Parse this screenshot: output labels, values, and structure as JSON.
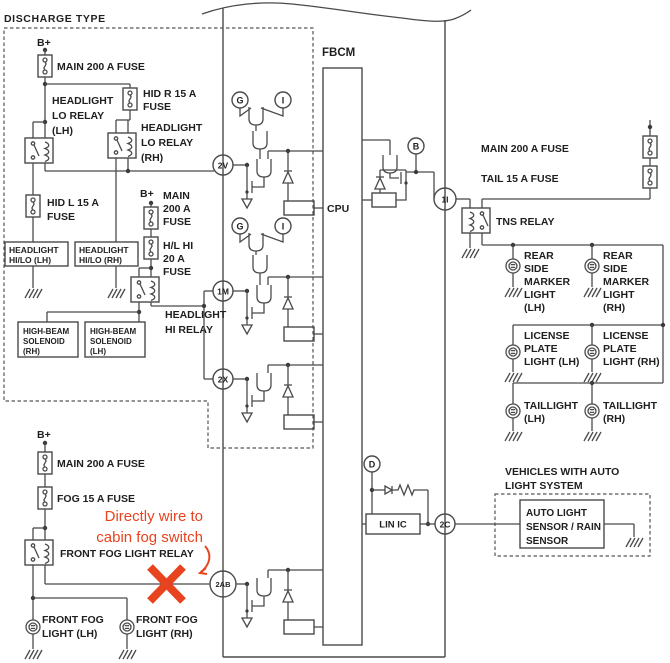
{
  "colors": {
    "line": "#4a4a4a",
    "text": "#1f1f1f",
    "red": "#e8431f",
    "background": "#ffffff"
  },
  "labels": {
    "discharge_type": "DISCHARGE TYPE",
    "b_plus": "B+",
    "fbcm": "FBCM",
    "cpu": "CPU",
    "lin_ic": "LIN IC"
  },
  "left": {
    "main_fuse1": "MAIN 200 A FUSE",
    "lo_relay_lh": [
      "HEADLIGHT",
      "LO RELAY",
      "(LH)"
    ],
    "hid_r": [
      "HID R 15 A",
      "FUSE"
    ],
    "lo_relay_rh": [
      "HEADLIGHT",
      "LO RELAY",
      "(RH)"
    ],
    "hid_l": [
      "HID L 15 A",
      "FUSE"
    ],
    "main_fuse2": [
      "MAIN",
      "200 A",
      "FUSE"
    ],
    "hl_hi": [
      "H/L HI",
      "20 A",
      "FUSE"
    ],
    "hilo_lh": [
      "HEADLIGHT",
      "HI/LO (LH)"
    ],
    "hilo_rh": [
      "HEADLIGHT",
      "HI/LO (RH)"
    ],
    "sol_rh": [
      "HIGH-BEAM",
      "SOLENOID",
      "(RH)"
    ],
    "sol_lh": [
      "HIGH-BEAM",
      "SOLENOID",
      "(LH)"
    ],
    "hi_relay": [
      "HEADLIGHT",
      "HI RELAY"
    ]
  },
  "fog": {
    "main_fuse": "MAIN 200 A FUSE",
    "fog_fuse": "FOG 15 A FUSE",
    "relay": "FRONT FOG LIGHT RELAY",
    "lh": [
      "FRONT FOG",
      "LIGHT (LH)"
    ],
    "rh": [
      "FRONT FOG",
      "LIGHT (RH)"
    ],
    "note": [
      "Directly wire to",
      "cabin fog switch"
    ]
  },
  "right": {
    "main_fuse": "MAIN 200 A FUSE",
    "tail_fuse": "TAIL 15 A FUSE",
    "tns": "TNS RELAY",
    "marker_lh": [
      "REAR",
      "SIDE",
      "MARKER",
      "LIGHT",
      "(LH)"
    ],
    "marker_rh": [
      "REAR",
      "SIDE",
      "MARKER",
      "LIGHT",
      "(RH)"
    ],
    "license_lh": [
      "LICENSE",
      "PLATE",
      "LIGHT (LH)"
    ],
    "license_rh": [
      "LICENSE",
      "PLATE",
      "LIGHT (RH)"
    ],
    "tail_lh": [
      "TAILLIGHT",
      "(LH)"
    ],
    "tail_rh": [
      "TAILLIGHT",
      "(RH)"
    ]
  },
  "auto": {
    "title": [
      "VEHICLES WITH AUTO",
      "LIGHT SYSTEM"
    ],
    "sensor": [
      "AUTO LIGHT",
      "SENSOR / RAIN",
      "SENSOR"
    ]
  },
  "connectors": {
    "v2": "2V",
    "m1": "1M",
    "x2": "2X",
    "ab2": "2AB",
    "i1": "1I",
    "c2": "2C"
  },
  "refs": {
    "g": "G",
    "i": "I",
    "b": "B",
    "d": "D"
  }
}
